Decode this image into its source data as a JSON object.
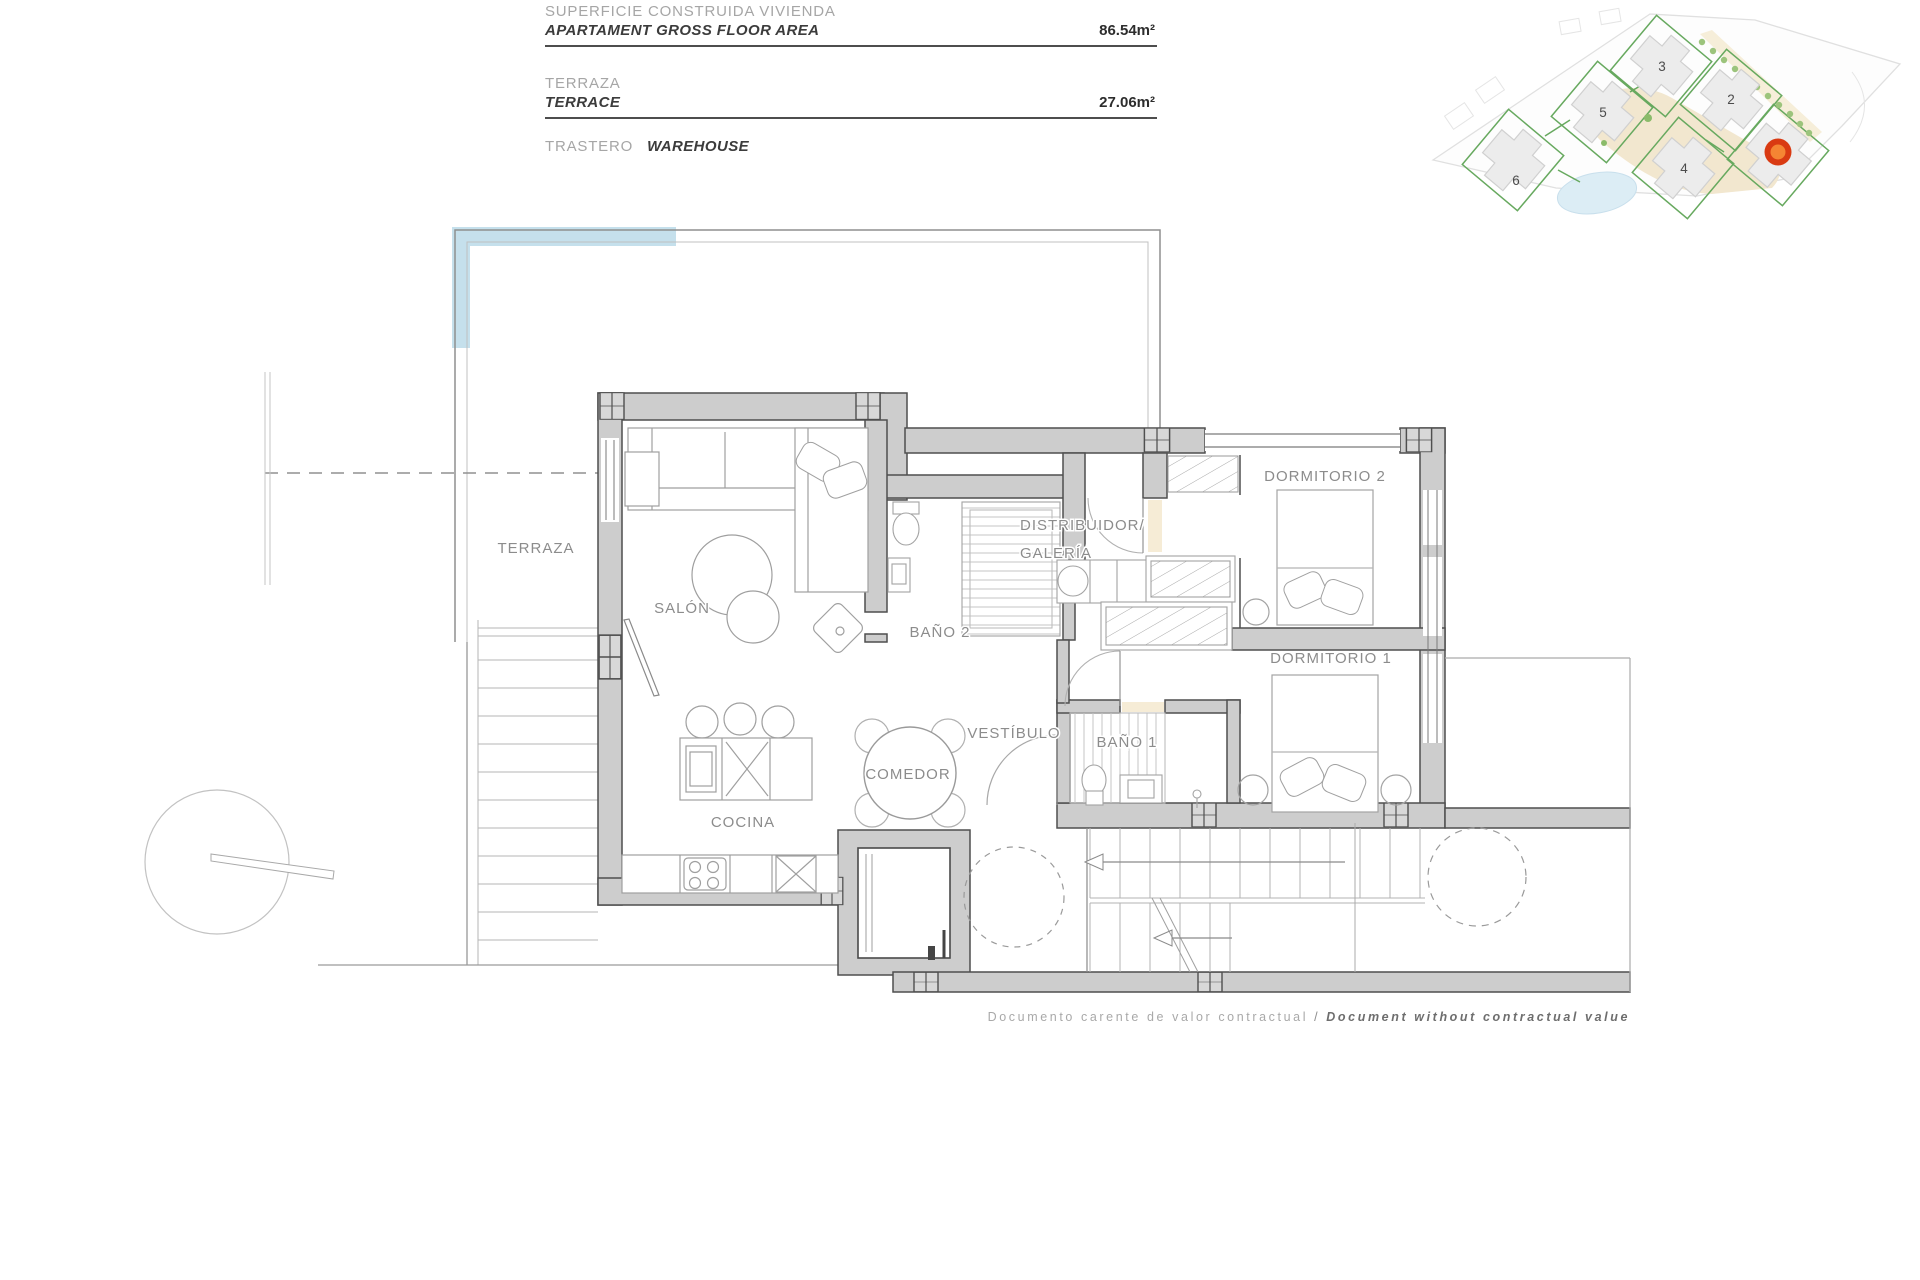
{
  "title_block": {
    "rows": [
      {
        "label_es": "SUPERFICIE CONSTRUIDA VIVIENDA",
        "label_en": "APARTAMENT GROSS FLOOR AREA",
        "value": "86.54m²"
      },
      {
        "label_es": "TERRAZA",
        "label_en": "TERRACE",
        "value": "27.06m²"
      },
      {
        "label_es": "TRASTERO",
        "label_en": "WAREHOUSE",
        "value": ""
      }
    ]
  },
  "floor_plan": {
    "rooms": {
      "terraza": "TERRAZA",
      "salon": "SALÓN",
      "bano2": "BAÑO 2",
      "distribuidor_line1": "DISTRIBUIDOR/",
      "distribuidor_line2": "GALERÍA",
      "dormitorio2": "DORMITORIO 2",
      "dormitorio1": "DORMITORIO 1",
      "vestibulo": "VESTÍBULO",
      "bano1": "BAÑO 1",
      "cocina": "COCINA",
      "comedor": "COMEDOR"
    }
  },
  "site_map": {
    "plot_numbers": [
      "2",
      "3",
      "4",
      "5",
      "6"
    ],
    "selected_marker_color": "#d93a12"
  },
  "footer": {
    "disclaimer_es": "Documento carente de valor contractual",
    "separator": " / ",
    "disclaimer_en": "Document without contractual value"
  }
}
